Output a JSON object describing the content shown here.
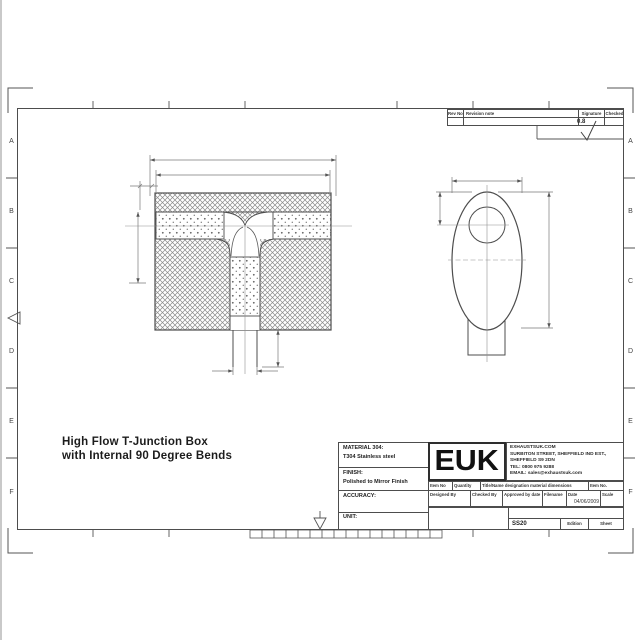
{
  "frame": {
    "row_labels": [
      "A",
      "B",
      "C",
      "D",
      "E",
      "F"
    ]
  },
  "revision_table": {
    "headers": [
      "Rev No",
      "Revision note",
      "Signature",
      "Checked"
    ]
  },
  "surface_finish": {
    "value": "0.8"
  },
  "drawing_title": {
    "line1": "High Flow T-Junction Box",
    "line2": "with Internal 90 Degree Bends"
  },
  "title_block": {
    "material_label": "MATERIAL 304:",
    "material_value": "T304 Stainless steel",
    "finish_label": "FINISH:",
    "finish_value": "Polished to Mirror Finish",
    "accuracy_label": "ACCURACY:",
    "unit_label": "UNIT:",
    "logo": "EUK",
    "address_lines": [
      "EXHAUSTSUK.COM",
      "SURBITON STREET, SHEFFIELD IND EST.,",
      "SHEFFIELD S9 2DN",
      "TEL: 0800 975 9288",
      "EMAIL: sales@exhaustsuk.com"
    ],
    "item_row": [
      "Item No",
      "Quantity",
      "Title/Name designation material dimensions",
      "Item No."
    ],
    "sign_row": [
      "Designed By",
      "Checked By",
      "Approved by date",
      "Filename",
      "Date",
      "Scale"
    ],
    "date_value": "04/06/2009",
    "filename_value": "SS20",
    "edition_label": "Edition",
    "sheet_label": "Sheet"
  },
  "colors": {
    "line": "#4d4d4d",
    "dim_line": "#7a7a7a",
    "hatch": "#8a8a8a"
  }
}
